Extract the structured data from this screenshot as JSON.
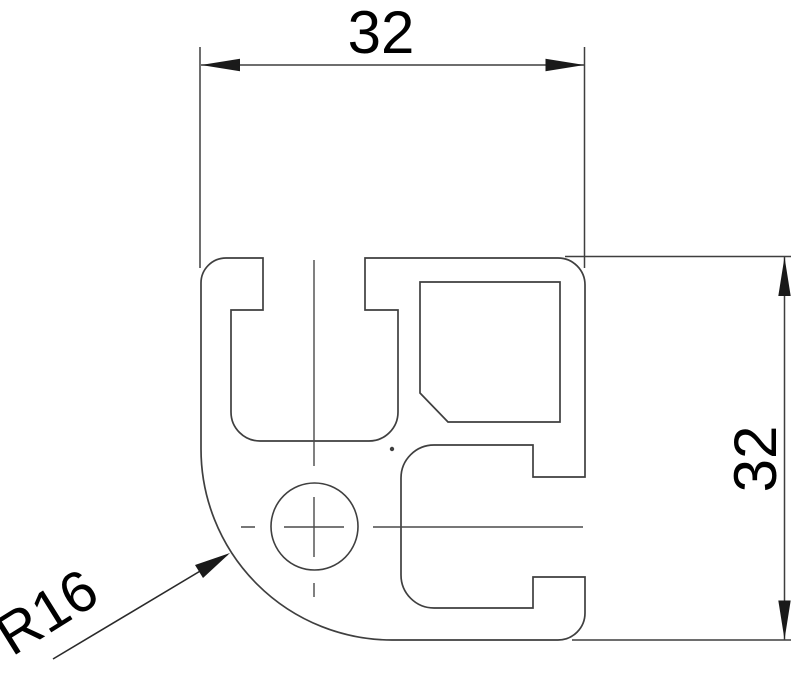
{
  "drawing": {
    "type": "technical-cross-section",
    "dimensions": {
      "width": {
        "value": "32"
      },
      "height": {
        "value": "32"
      },
      "corner_radius": {
        "value": "R16"
      }
    },
    "style": {
      "line_color": "#3f3f3f",
      "text_color": "#000000",
      "background": "#ffffff"
    }
  }
}
